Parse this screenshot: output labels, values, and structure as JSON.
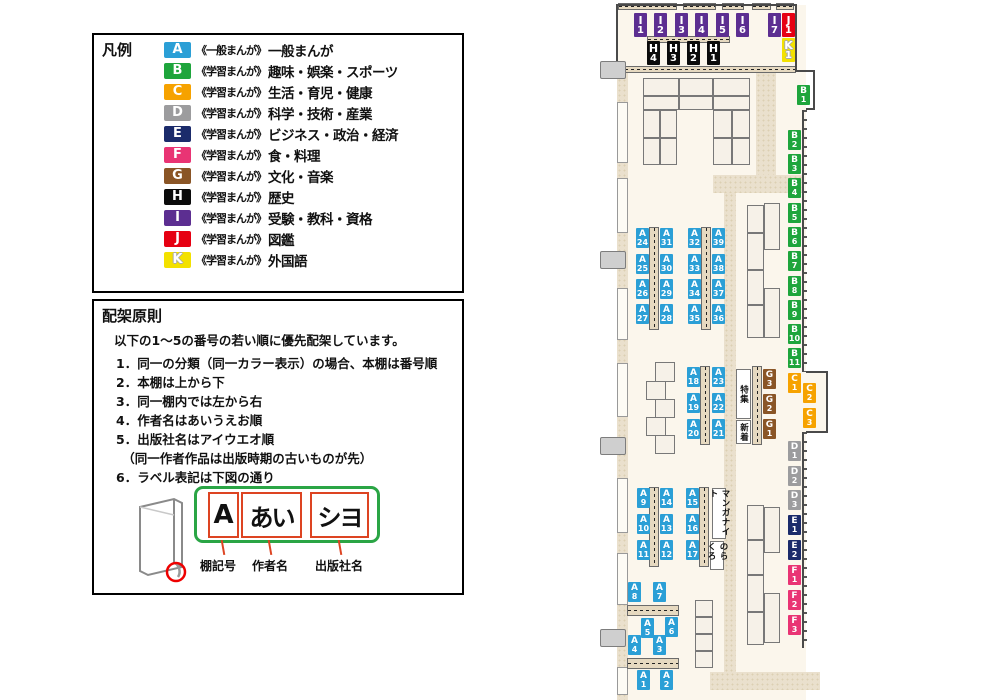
{
  "legend": {
    "title": "凡例",
    "items": [
      {
        "code": "A",
        "color": "#2B9FD6",
        "scope": "《一般まんが》",
        "label": "一般まんが"
      },
      {
        "code": "B",
        "color": "#1EA53C",
        "scope": "《学習まんが》",
        "label": "趣味・娯楽・スポーツ"
      },
      {
        "code": "C",
        "color": "#F6A200",
        "scope": "《学習まんが》",
        "label": "生活・育児・健康"
      },
      {
        "code": "D",
        "color": "#9C9C9E",
        "scope": "《学習まんが》",
        "label": "科学・技術・産業"
      },
      {
        "code": "E",
        "color": "#1B2B6B",
        "scope": "《学習まんが》",
        "label": "ビジネス・政治・経済"
      },
      {
        "code": "F",
        "color": "#E93474",
        "scope": "《学習まんが》",
        "label": "食・料理"
      },
      {
        "code": "G",
        "color": "#8A5526",
        "scope": "《学習まんが》",
        "label": "文化・音楽"
      },
      {
        "code": "H",
        "color": "#0B0B0B",
        "scope": "《学習まんが》",
        "label": "歴史"
      },
      {
        "code": "I",
        "color": "#5C2E91",
        "scope": "《学習まんが》",
        "label": "受験・教科・資格"
      },
      {
        "code": "J",
        "color": "#E60012",
        "scope": "《学習まんが》",
        "label": "図鑑"
      },
      {
        "code": "K",
        "color": "#F3E100",
        "scope": "《学習まんが》",
        "label": "外国語"
      }
    ]
  },
  "principles": {
    "title": "配架原則",
    "intro": "以下の1～5の番号の若い順に優先配架しています。",
    "rules": [
      "1．同一の分類（同一カラー表示）の場合、本棚は番号順",
      "2．本棚は上から下",
      "3．同一棚内では左から右",
      "4．作者名はあいうえお順",
      "5．出版社名はアイウエオ順\n　（同一作者作品は出版時期の古いものが先）",
      "6．ラベル表記は下図の通り"
    ],
    "label_example": {
      "shelf_code": "A",
      "author": "あい",
      "publisher": "シヨ",
      "captions": [
        "棚記号",
        "作者名",
        "出版社名"
      ]
    }
  },
  "map": {
    "colors": {
      "A": "#2B9FD6",
      "B": "#1EA53C",
      "C": "#F6A200",
      "D": "#9C9C9E",
      "E": "#1B2B6B",
      "F": "#E93474",
      "G": "#8A5526",
      "H": "#0B0B0B",
      "I": "#5C2E91",
      "J": "#E60012",
      "K": "#F3E100"
    },
    "shelf_labels": [
      {
        "id": "I1",
        "x": 634,
        "y": 13,
        "big": true
      },
      {
        "id": "I2",
        "x": 654,
        "y": 13,
        "big": true
      },
      {
        "id": "I3",
        "x": 675,
        "y": 13,
        "big": true
      },
      {
        "id": "I4",
        "x": 695,
        "y": 13,
        "big": true
      },
      {
        "id": "I5",
        "x": 716,
        "y": 13,
        "big": true
      },
      {
        "id": "I6",
        "x": 736,
        "y": 13,
        "big": true
      },
      {
        "id": "I7",
        "x": 768,
        "y": 13,
        "big": true
      },
      {
        "id": "J1",
        "x": 782,
        "y": 13,
        "big": true
      },
      {
        "id": "K1",
        "x": 782,
        "y": 38,
        "big": true
      },
      {
        "id": "H4",
        "x": 647,
        "y": 41,
        "big": true
      },
      {
        "id": "H3",
        "x": 667,
        "y": 41,
        "big": true
      },
      {
        "id": "H2",
        "x": 687,
        "y": 41,
        "big": true
      },
      {
        "id": "H1",
        "x": 707,
        "y": 41,
        "big": true
      },
      {
        "id": "B1",
        "x": 797,
        "y": 85
      },
      {
        "id": "B2",
        "x": 788,
        "y": 130
      },
      {
        "id": "B3",
        "x": 788,
        "y": 154
      },
      {
        "id": "B4",
        "x": 788,
        "y": 178
      },
      {
        "id": "B5",
        "x": 788,
        "y": 203
      },
      {
        "id": "B6",
        "x": 788,
        "y": 227
      },
      {
        "id": "B7",
        "x": 788,
        "y": 251
      },
      {
        "id": "B8",
        "x": 788,
        "y": 276
      },
      {
        "id": "B9",
        "x": 788,
        "y": 300
      },
      {
        "id": "B10",
        "x": 788,
        "y": 324
      },
      {
        "id": "B11",
        "x": 788,
        "y": 348
      },
      {
        "id": "C1",
        "x": 788,
        "y": 373
      },
      {
        "id": "C2",
        "x": 803,
        "y": 383
      },
      {
        "id": "C3",
        "x": 803,
        "y": 408
      },
      {
        "id": "D1",
        "x": 788,
        "y": 441
      },
      {
        "id": "D2",
        "x": 788,
        "y": 466
      },
      {
        "id": "D3",
        "x": 788,
        "y": 490
      },
      {
        "id": "E1",
        "x": 788,
        "y": 515
      },
      {
        "id": "E2",
        "x": 788,
        "y": 540
      },
      {
        "id": "F1",
        "x": 788,
        "y": 565
      },
      {
        "id": "F2",
        "x": 788,
        "y": 590
      },
      {
        "id": "F3",
        "x": 788,
        "y": 615
      },
      {
        "id": "G3",
        "x": 763,
        "y": 369
      },
      {
        "id": "G2",
        "x": 763,
        "y": 394
      },
      {
        "id": "G1",
        "x": 763,
        "y": 419
      },
      {
        "id": "A24",
        "x": 636,
        "y": 228
      },
      {
        "id": "A25",
        "x": 636,
        "y": 254
      },
      {
        "id": "A26",
        "x": 636,
        "y": 279
      },
      {
        "id": "A27",
        "x": 636,
        "y": 304
      },
      {
        "id": "A31",
        "x": 660,
        "y": 228
      },
      {
        "id": "A30",
        "x": 660,
        "y": 254
      },
      {
        "id": "A29",
        "x": 660,
        "y": 279
      },
      {
        "id": "A28",
        "x": 660,
        "y": 304
      },
      {
        "id": "A32",
        "x": 688,
        "y": 228
      },
      {
        "id": "A33",
        "x": 688,
        "y": 254
      },
      {
        "id": "A34",
        "x": 688,
        "y": 279
      },
      {
        "id": "A35",
        "x": 688,
        "y": 304
      },
      {
        "id": "A39",
        "x": 712,
        "y": 228
      },
      {
        "id": "A38",
        "x": 712,
        "y": 254
      },
      {
        "id": "A37",
        "x": 712,
        "y": 279
      },
      {
        "id": "A36",
        "x": 712,
        "y": 304
      },
      {
        "id": "A18",
        "x": 687,
        "y": 367
      },
      {
        "id": "A19",
        "x": 687,
        "y": 393
      },
      {
        "id": "A20",
        "x": 687,
        "y": 419
      },
      {
        "id": "A23",
        "x": 712,
        "y": 367
      },
      {
        "id": "A22",
        "x": 712,
        "y": 393
      },
      {
        "id": "A21",
        "x": 712,
        "y": 419
      },
      {
        "id": "A9",
        "x": 637,
        "y": 488
      },
      {
        "id": "A10",
        "x": 637,
        "y": 514
      },
      {
        "id": "A11",
        "x": 637,
        "y": 540
      },
      {
        "id": "A14",
        "x": 660,
        "y": 488
      },
      {
        "id": "A13",
        "x": 660,
        "y": 514
      },
      {
        "id": "A12",
        "x": 660,
        "y": 540
      },
      {
        "id": "A15",
        "x": 686,
        "y": 488
      },
      {
        "id": "A16",
        "x": 686,
        "y": 514
      },
      {
        "id": "A17",
        "x": 686,
        "y": 540
      },
      {
        "id": "A8",
        "x": 628,
        "y": 582
      },
      {
        "id": "A7",
        "x": 653,
        "y": 582
      },
      {
        "id": "A5",
        "x": 641,
        "y": 618
      },
      {
        "id": "A6",
        "x": 665,
        "y": 617
      },
      {
        "id": "A4",
        "x": 628,
        "y": 635
      },
      {
        "id": "A3",
        "x": 653,
        "y": 635
      },
      {
        "id": "A1",
        "x": 637,
        "y": 670
      },
      {
        "id": "A2",
        "x": 660,
        "y": 670
      }
    ],
    "area_labels": [
      {
        "text": "特集",
        "x": 736,
        "y": 369,
        "w": 15,
        "h": 50
      },
      {
        "text": "新着",
        "x": 736,
        "y": 420,
        "w": 15,
        "h": 24
      },
      {
        "text": "マンガナイト",
        "x": 712,
        "y": 488,
        "w": 14,
        "h": 51
      },
      {
        "text": "のらくろ",
        "x": 710,
        "y": 541,
        "w": 14,
        "h": 29
      }
    ]
  }
}
